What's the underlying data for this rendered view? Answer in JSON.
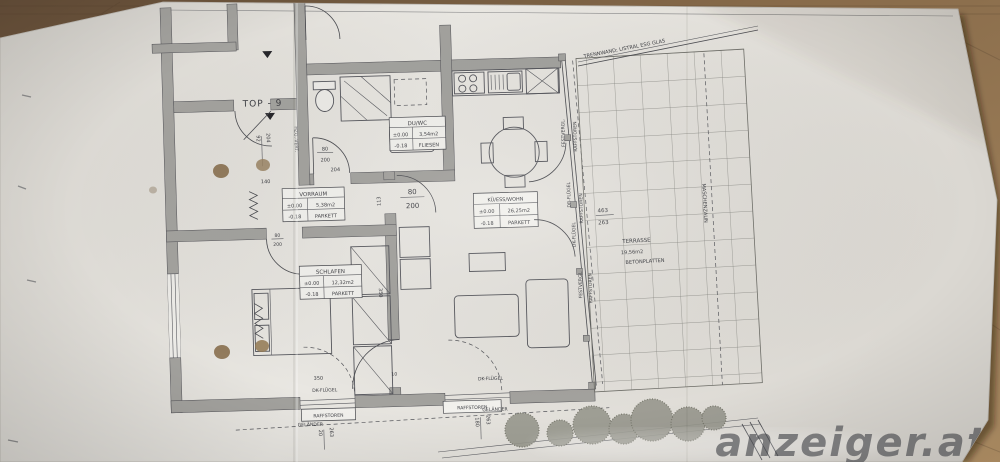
{
  "photo": {
    "watermark": "anzeiger.at",
    "accent_wood": "#8a6b47",
    "paper_color": "#e6e4df"
  },
  "plan": {
    "unit": "TOP - 9",
    "partition": "TRENNWAND; LISTRAL ESG GLAS",
    "fence": "MASCHENZAUN",
    "heating": "HZG.-VERT.",
    "railing": "GELÄNDER",
    "rooms": {
      "duwc": {
        "name": "DU/WC",
        "lvl": "±0.00",
        "area": "3,54m2",
        "sub": "-0.18",
        "floor": "FLIESEN"
      },
      "vorraum": {
        "name": "VORRAUM",
        "lvl": "±0.00",
        "area": "5,38m2",
        "sub": "-0.18",
        "floor": "PARKETT"
      },
      "schlafen": {
        "name": "SCHLAFEN",
        "lvl": "±0.00",
        "area": "12,32m2",
        "sub": "-0.18",
        "floor": "PARKETT"
      },
      "wohn": {
        "name": "KÜ/ESS/WOHN",
        "lvl": "±0.00",
        "area": "26,25m2",
        "sub": "-0.18",
        "floor": "PARKETT"
      },
      "terrasse": {
        "name": "TERRASSE",
        "area": "19,56m2",
        "floor": "BETONPLATTEN"
      }
    },
    "labels": {
      "fest": "FESTVERGL.",
      "raff": "RAFFSTOREN",
      "dr": "DR-FLÜGEL",
      "dk": "DK-FLÜGEL"
    },
    "dims": {
      "d92": "92",
      "d204": "204",
      "d140": "140",
      "d80": "80",
      "d200": "200",
      "d113": "113",
      "d350": "350",
      "d10": "10",
      "d20": "20",
      "d263": "263",
      "d180": "180",
      "d463": "463"
    }
  }
}
